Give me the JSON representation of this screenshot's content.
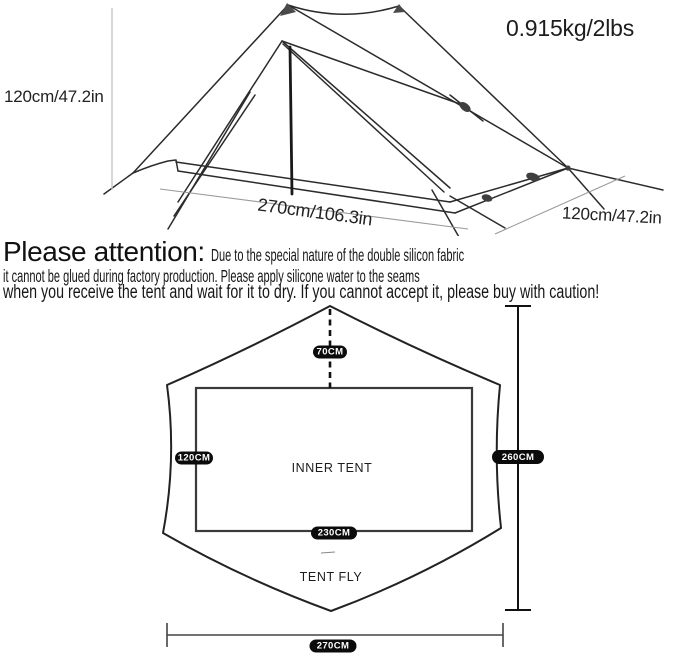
{
  "tent_illustration": {
    "weight_label": "0.915kg/2lbs",
    "height_label": "120cm/47.2in",
    "length_label": "270cm/106.3in",
    "width_label": "120cm/47.2in"
  },
  "attention_note": {
    "heading": "Please attention:",
    "line1_rest": "Due to the special nature of the double silicon fabric",
    "line2": "it cannot be glued during factory production. Please apply silicone water to the seams",
    "line3": "when you receive the tent and wait for it to dry. If you cannot accept it, please buy with caution!"
  },
  "floor_plan": {
    "labels": {
      "inner_tent": "INNER TENT",
      "tent_fly": "TENT FLY"
    },
    "dimensions": {
      "ridge_offset": "70CM",
      "inner_width": "120CM",
      "fly_length": "260CM",
      "inner_length": "230CM",
      "fly_width": "270CM"
    }
  },
  "colors": {
    "line": "#2b2b2b",
    "pill_bg": "#0b0b0b",
    "pill_text": "#ffffff",
    "background": "#ffffff"
  }
}
